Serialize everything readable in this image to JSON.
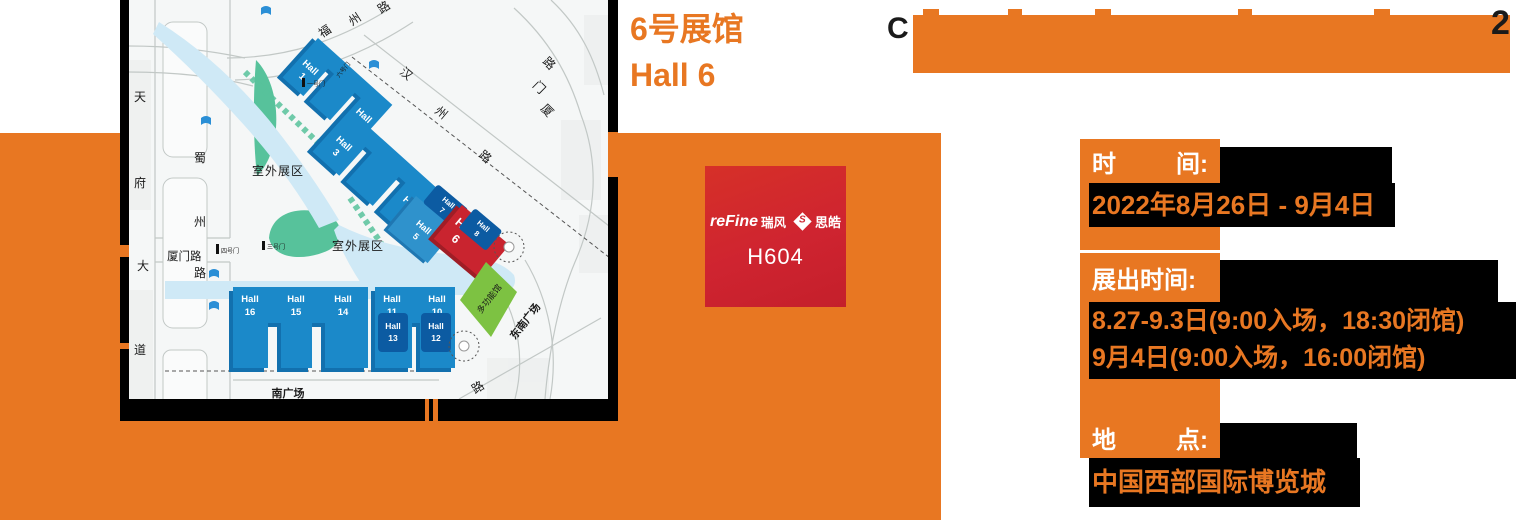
{
  "colors": {
    "orange": "#e87722",
    "badge_red": "#cf2430",
    "hall_blue": "#1b89c9",
    "hall_dark_blue": "#0c5ba2",
    "hall_mid_blue": "#2f92cc",
    "hall_red": "#c9242f",
    "green_bright": "#7dc242",
    "green_teal": "#57c29b",
    "water_blue": "#cfe9f6"
  },
  "headline": {
    "line1": "6号展馆",
    "line2": "Hall 6"
  },
  "banner": {
    "glyph_left": "C",
    "glyph_right": "2"
  },
  "badge": {
    "brand": "reFine",
    "brand_suffix": "瑞风",
    "icon_letter": "S",
    "partner": "思皓",
    "booth": "H604"
  },
  "info_sections": [
    {
      "label_parts": [
        "时",
        "间:"
      ],
      "lines": [
        "2022年8月26日 - 9月4日"
      ]
    },
    {
      "label_parts": [
        "展出时间:"
      ],
      "lines": [
        "8.27-9.3日(9:00入场，18:30闭馆)",
        "9月4日(9:00入场，16:00闭馆)"
      ]
    },
    {
      "label_parts": [
        "地",
        "点:"
      ],
      "lines": [
        "中国西部国际博览城"
      ]
    }
  ],
  "map": {
    "halls": {
      "h1": {
        "w": "Hall",
        "n": "1"
      },
      "h2": {
        "w": "Hall",
        "n": "2"
      },
      "h3": {
        "w": "Hall",
        "n": "3"
      },
      "h4": {
        "w": "Hall",
        "n": "4"
      },
      "h5": {
        "w": "Hall",
        "n": "5"
      },
      "h6": {
        "w": "Hall",
        "n": "6"
      },
      "h7": {
        "w": "Hall",
        "n": "7"
      },
      "h8": {
        "w": "Hall",
        "n": "8"
      },
      "h10": {
        "w": "Hall",
        "n": "10"
      },
      "h11": {
        "w": "Hall",
        "n": "11"
      },
      "h12": {
        "w": "Hall",
        "n": "12"
      },
      "h13": {
        "w": "Hall",
        "n": "13"
      },
      "h14": {
        "w": "Hall",
        "n": "14"
      },
      "h15": {
        "w": "Hall",
        "n": "15"
      },
      "h16": {
        "w": "Hall",
        "n": "16"
      }
    },
    "roads": {
      "fuzhou": [
        "福",
        "州",
        "路"
      ],
      "hanzhou": [
        "汉",
        "州",
        "路"
      ],
      "xiamen": [
        "厦",
        "门",
        "路"
      ],
      "tianfu": [
        "天",
        "府",
        "大",
        "道"
      ],
      "shuzhou": [
        "蜀",
        "州",
        "路"
      ],
      "xiamen_left": "厦门路",
      "lu": "路"
    },
    "areas": {
      "outdoor1": "室外展区",
      "outdoor2": "室外展区",
      "south": "南广场",
      "southeast": "东南广场",
      "multi": "多功能馆"
    },
    "gates": {
      "g1": "一号门",
      "g6": "六号门",
      "g3": "三号门",
      "g4": "四号门"
    }
  }
}
